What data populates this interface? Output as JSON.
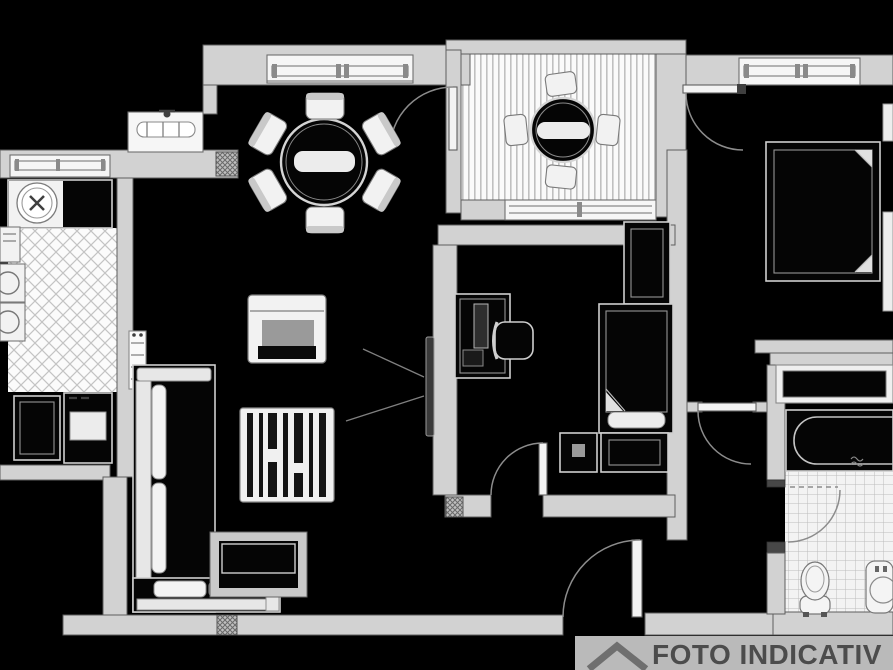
{
  "banner": {
    "text": "FOTO INDICATIV",
    "icon": "roof-chevron-icon",
    "bg_color": "#c8c8c8",
    "text_color": "#4c4c4c"
  },
  "palette": {
    "background": "#000000",
    "wall_fill": "#d2d2d2",
    "wall_outline": "#5e5e5e",
    "drawing_line": "#cfcfcf",
    "white_fill": "#f2f2f2",
    "tv_fill": "#3a3a3a",
    "banner_bg": "#c8c8c8",
    "banner_text": "#4c4c4c"
  },
  "floor_patterns": {
    "kitchen": "diamond-lattice",
    "balcony": "vertical-plank-stripes",
    "bathroom": "square-tile-grid",
    "wall_piers": "crosshatch"
  },
  "rooms": [
    {
      "name": "kitchen"
    },
    {
      "name": "dining-area"
    },
    {
      "name": "balcony"
    },
    {
      "name": "living-room"
    },
    {
      "name": "bedroom-middle"
    },
    {
      "name": "bedroom-right"
    },
    {
      "name": "bathroom"
    },
    {
      "name": "corridor"
    },
    {
      "name": "entrance-hall"
    }
  ],
  "furniture": {
    "kitchen": [
      "sink-counter",
      "round-sink",
      "washing-machine",
      "oven-appliance",
      "base-cabinet",
      "base-cabinet"
    ],
    "dining-area": [
      "round-dining-table",
      "dining-chair x6",
      "sideboard",
      "radiator-window"
    ],
    "balcony": [
      "round-bistro-table",
      "balcony-chair x4"
    ],
    "living-room": [
      "l-shaped-sofa",
      "coffee-table",
      "striped-rug",
      "wall-tv",
      "radiator"
    ],
    "bedroom-middle": [
      "desk-with-monitor",
      "desk-chair",
      "wardrobe",
      "single-bed",
      "nightstand",
      "side-table"
    ],
    "bedroom-right": [
      "double-bed",
      "nightstand",
      "nightstand",
      "low-closet"
    ],
    "bathroom": [
      "bathtub",
      "toilet",
      "washbasin"
    ]
  },
  "doors": [
    "balcony-door",
    "bedroom-right-door",
    "bedroom-middle-door",
    "corridor-door",
    "bathroom-door",
    "entrance-door"
  ],
  "windows": [
    "kitchen-window",
    "kitchen-high-window",
    "dining-window",
    "balcony-window",
    "bedroom-right-window"
  ]
}
